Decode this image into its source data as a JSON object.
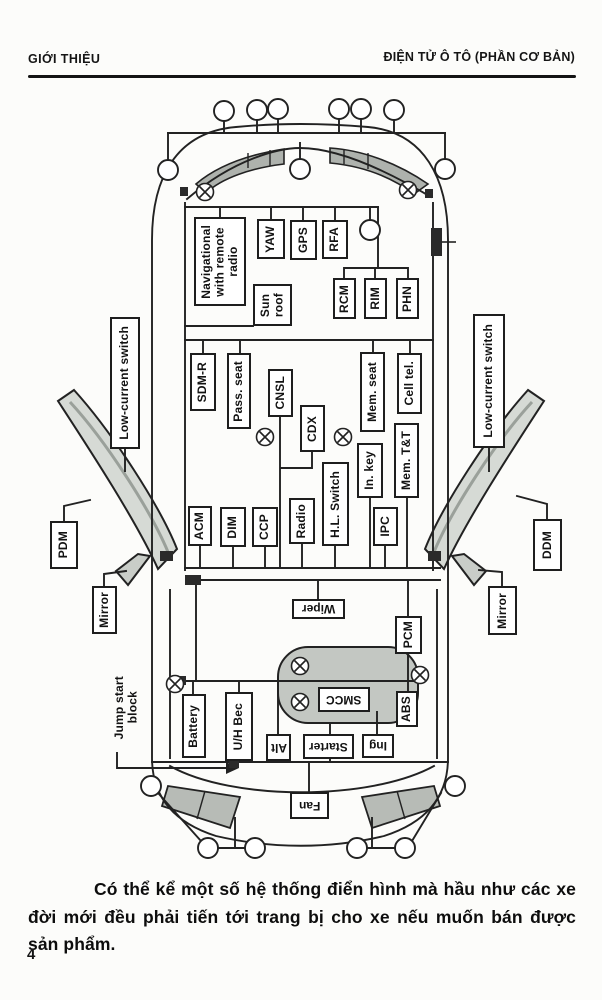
{
  "header": {
    "left": "GIỚI THIỆU",
    "right": "ĐIỆN TỬ Ô TÔ (PHẦN CƠ BẢN)"
  },
  "diagram": {
    "modules": {
      "nav_radio": "Navigational\nwith remote\nradio",
      "yaw": "YAW",
      "gps": "GPS",
      "rfa": "RFA",
      "sun_roof": "Sun\nroof",
      "rcm": "RCM",
      "rim": "RIM",
      "phn": "PHN",
      "sdm_r": "SDM-R",
      "pass_seat": "Pass. seat",
      "cnsl": "CNSL",
      "cdx": "CDX",
      "mem_seat": "Mem. seat",
      "cell_tel": "Cell tel.",
      "in_key": "In. key",
      "mem_tt": "Mem. T&T",
      "acm": "ACM",
      "dim": "DIM",
      "ccp": "CCP",
      "radio": "Radio",
      "hl_switch": "H.L. Switch",
      "ipc": "IPC",
      "lcs_left": "Low-current switch",
      "lcs_right": "Low-current switch",
      "pdm": "PDM",
      "ddm": "DDM",
      "mirror_left": "Mirror",
      "mirror_right": "Mirror",
      "wiper": "Wiper",
      "pcm": "PCM",
      "smcc": "SMCC",
      "abs": "ABS",
      "battery": "Battery",
      "uh_bec": "U/H Bec",
      "alt": "Alt",
      "starter": "Starter",
      "ing": "Ing",
      "fan": "Fan",
      "jump_start": "Jump start\nblock"
    },
    "line_color": "#222222",
    "shade_color": "#b2b6b1"
  },
  "paragraph": {
    "text": "Có thể kể một số hệ thống điển hình mà hầu như các xe đời mới đều phải tiến tới trang bị cho xe nếu muốn bán được sản phẩm."
  },
  "footer": {
    "page_number": "4"
  }
}
